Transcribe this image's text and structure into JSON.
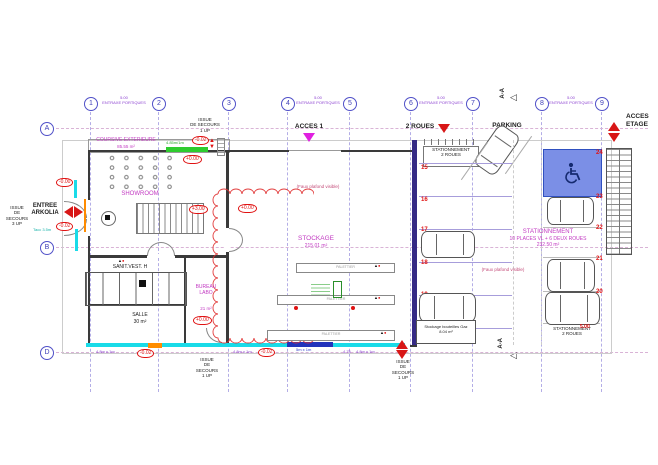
{
  "grid": {
    "cols": [
      "1",
      "2",
      "3",
      "4",
      "5",
      "6",
      "7",
      "8",
      "9"
    ],
    "rows": [
      "A",
      "B",
      "D"
    ],
    "entraxe_value": "5.00",
    "entraxe_label": "ENTRAXE PORTIQUES"
  },
  "section": {
    "label": "A-A",
    "triangle": "◁"
  },
  "exits": {
    "left": "ISSUE\nDE\nSECOURS\n3 UP",
    "top": "ISSUE\nDE SECOURS\n1 UP",
    "bottom_left": "ISSUE\nDE\nSECOURS\n1 UP",
    "bottom_right": "ISSUE\nDE\nSECOURS\n1 UP"
  },
  "entrance": {
    "line1": "ENTREE",
    "line2": "ARKOLIA",
    "clearance": "Tacc 3.5m"
  },
  "access": {
    "acces1": "ACCES 1",
    "two_wheels": "2 ROUES",
    "parking": "PARKING",
    "floor": "ACCES\nETAGE"
  },
  "rooms": {
    "coursive": {
      "name": "COURSIVE EXTERIEURE",
      "area": "85.55 m²",
      "dim": "4.85m/1m"
    },
    "showroom": {
      "name": "SHOWROOM"
    },
    "stockage": {
      "name": "STOCKAGE",
      "area": "215.01 m²",
      "ceiling_note": "(Faux plafond visible)"
    },
    "sanit": {
      "name": "SANIT.VEST. H"
    },
    "salle": {
      "name": "SALLE",
      "area": "30 m²"
    },
    "bureau": {
      "name": "BUREAU\nLABO",
      "area": "21 m²"
    },
    "gaz": {
      "name": "Stockage bouteilles Gaz",
      "area": "8.04 m²"
    },
    "parking_main": {
      "name": "STATIONNEMENT",
      "detail": "10 PLACES VL + 6 DEUX ROUES",
      "area": "232.50 m²",
      "ceiling_note": "(Faux plafond visible)"
    },
    "bike_top": {
      "line1": "STATIONNEMENT",
      "line2": "2 ROUES"
    },
    "bike_bottom": {
      "line1": "STATIONNEMENT",
      "line2": "2 ROUES"
    }
  },
  "levels": {
    "entry_top": "-0.00",
    "entry_bottom": "-0.02",
    "exit_top": "-0.02",
    "showroom_top": "+0.00",
    "stair": "+3.00",
    "stockage": "+0.00",
    "bureau": "+0.00",
    "salle_floor": "-0.02",
    "stockage_floor": "-0.02"
  },
  "parking_dim": "5.00",
  "stalls": {
    "left": [
      "15",
      "16",
      "17",
      "18",
      "19"
    ],
    "right": [
      "24",
      "23",
      "22",
      "21",
      "20"
    ]
  },
  "dimensions": {
    "bottom1": "4.8m x 1m",
    "bottom2": "4.8m x 1m",
    "bottom3": "4.75",
    "bottom4": "4.8m x 1m",
    "walkway": "5m x 1m"
  },
  "racks": {
    "label": "PALETTIER"
  },
  "colors": {
    "accent_red": "#d81616",
    "magenta": "#c23ac2",
    "grid_purple": "#5050c8",
    "cyan": "#19dbe8",
    "orange": "#ff8c00",
    "green": "#2ecc2e",
    "navy": "#2a2a8c",
    "parking_blue": "#7b8fe6"
  }
}
